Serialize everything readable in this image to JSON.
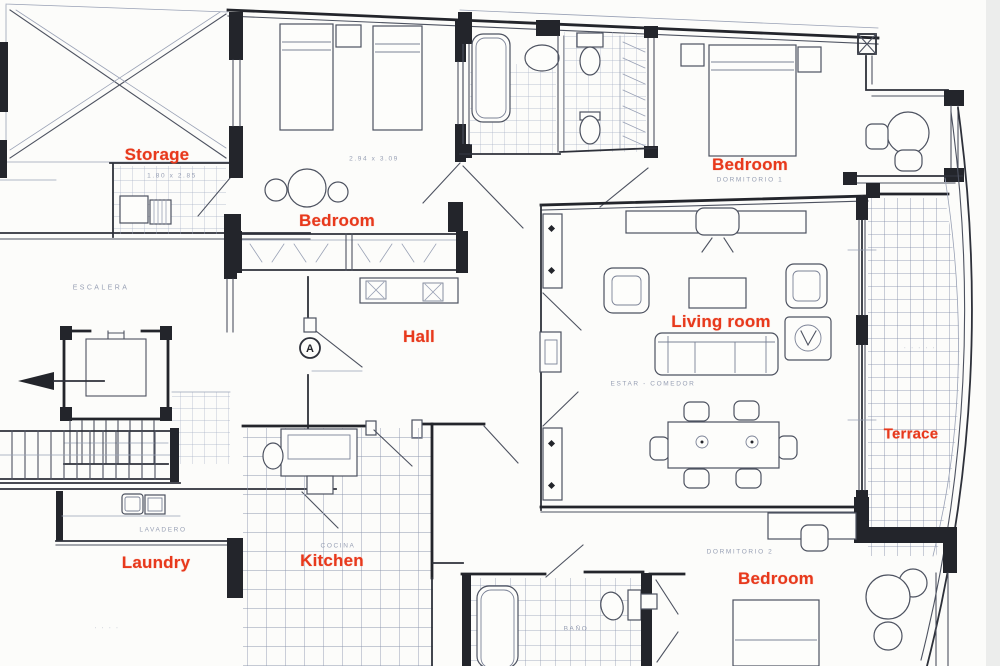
{
  "document": {
    "type": "apartment floor plan",
    "style": "scanned architectural drawing"
  },
  "colors": {
    "label_red": "#e8391c",
    "ink": "#23252b",
    "ink_light": "#8b93a8",
    "paper": "#fcfcfa",
    "tile": "#9aa3ba"
  },
  "rooms": {
    "storage": "Storage",
    "bedroom_top_left": "Bedroom",
    "bedroom_top_right": "Bedroom",
    "hall": "Hall",
    "living_room": "Living room",
    "terrace": "Terrace",
    "laundry": "Laundry",
    "kitchen": "Kitchen",
    "bedroom_bottom": "Bedroom"
  },
  "annotations": {
    "stairs": "ESCALERA",
    "storage_dims": "1.80 x 2.85",
    "bedroom_top_left_dims": "2.94 x 3.09",
    "bedroom_top_right_dims": "DORMITORIO 1",
    "living_room_dims": "ESTAR - COMEDOR",
    "bedroom_bottom_dims": "DORMITORIO 2",
    "laundry_dims": "LAVADERO",
    "kitchen_dims": "COCINA",
    "bathroom_dims": "BAÑO",
    "terrace_marks": "· · · · ·",
    "exterior_marks": "· · · ·"
  },
  "markers": {
    "section_a": "A"
  }
}
